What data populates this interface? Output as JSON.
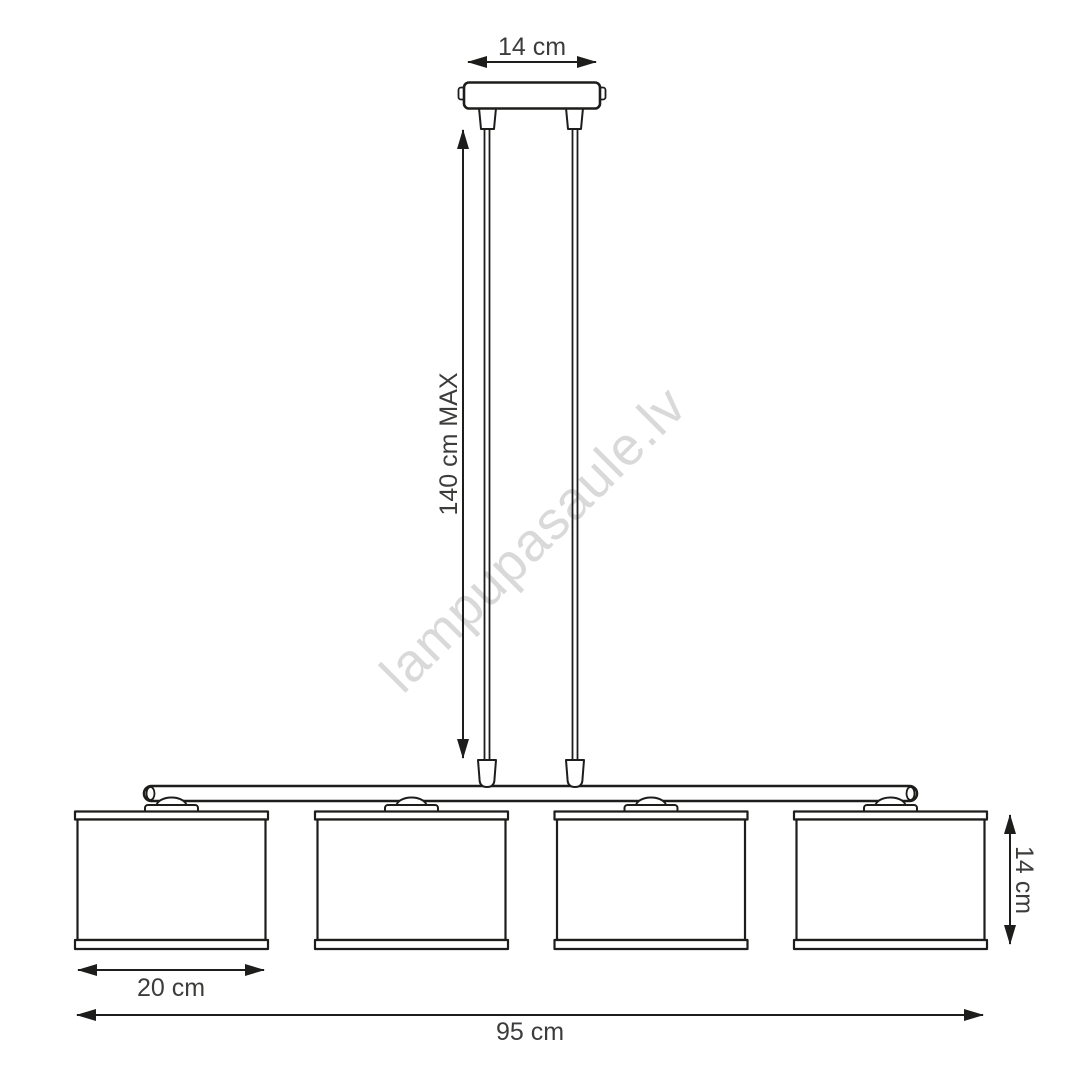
{
  "drawing": {
    "labels": {
      "canopy_width": "14 cm",
      "max_drop": "140 cm MAX",
      "shade_height": "14 cm",
      "shade_width": "20 cm",
      "total_width": "95 cm"
    },
    "watermark": "lampupasaule.lv",
    "shade_count": "4",
    "colors": {
      "line": "#1d1d1b",
      "dimension_text": "#3c3c3b",
      "watermark": "#d9d9d9"
    }
  }
}
